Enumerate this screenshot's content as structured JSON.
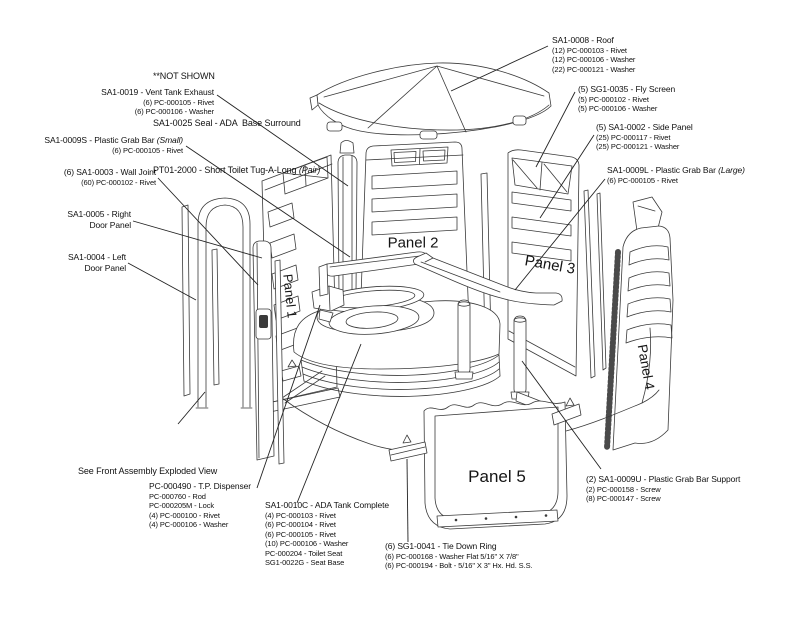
{
  "diagram": {
    "colors": {
      "background": "#ffffff",
      "ink": "#111111",
      "art_line": "#3a3a3a",
      "leader_line": "#222222"
    },
    "not_shown": {
      "line1": "**NOT SHOWN",
      "line2": "SA1-0025 Seal - ADA  Base Surround",
      "line3": "PT01-2000 - Short Toilet Tug-A-Long ",
      "line3_italic": "(Pair)"
    },
    "note": {
      "text": "See Front Assembly Exploded View",
      "leader": [
        178,
        424,
        205,
        392
      ]
    },
    "labels": [
      {
        "id": "roof",
        "title": "SA1-0008 - Roof",
        "subs": [
          "(12) PC-000103 - Rivet",
          "(12) PC-000106 - Washer",
          "(22) PC-000121 - Washer"
        ],
        "x": 552,
        "y": 35,
        "align": "left",
        "leader": [
          548,
          46,
          451,
          91
        ]
      },
      {
        "id": "fly-screen",
        "title": "(5) SG1-0035 - Fly Screen",
        "subs": [
          "(5) PC-000102 - Rivet",
          "(5) PC-000106 - Washer"
        ],
        "x": 578,
        "y": 84,
        "align": "left",
        "leader": [
          575,
          92,
          536,
          167
        ]
      },
      {
        "id": "side-panel",
        "title": "(5) SA1-0002 - Side Panel",
        "subs": [
          "(25) PC-000117 - Rivet",
          "(25) PC-000121 - Washer"
        ],
        "x": 596,
        "y": 122,
        "align": "left",
        "leader": [
          594,
          135,
          540,
          218
        ]
      },
      {
        "id": "grab-bar-large",
        "title": "SA1-0009L - Plastic Grab Bar ",
        "title_italic": "(Large)",
        "subs": [
          "(6) PC-000105 - Rivet"
        ],
        "x": 607,
        "y": 165,
        "align": "left",
        "leader": [
          605,
          179,
          515,
          290
        ]
      },
      {
        "id": "grab-bar-support",
        "title": "(2) SA1-0009U - Plastic Grab Bar Support",
        "subs": [
          "(2) PC-000158 - Screw",
          "(8) PC-000147 - Screw"
        ],
        "x": 586,
        "y": 474,
        "align": "left",
        "leader": [
          601,
          469,
          522,
          361
        ]
      },
      {
        "id": "vent-exhaust",
        "title": "SA1-0019 - Vent Tank Exhaust",
        "subs": [
          "(6) PC-000105 - Rivet",
          "(6) PC-000106 - Washer"
        ],
        "x": 214,
        "y": 87,
        "align": "right",
        "leader": [
          217,
          95,
          348,
          186
        ]
      },
      {
        "id": "grab-bar-small",
        "title": "SA1-0009S - Plastic Grab Bar ",
        "title_italic": "(Small)",
        "subs": [
          "(6) PC-000105 - Rivet"
        ],
        "x": 183,
        "y": 135,
        "align": "right",
        "leader": [
          186,
          146,
          350,
          257
        ]
      },
      {
        "id": "wall-joint",
        "title": "(6) SA1-0003 - Wall Joint",
        "subs": [
          "(60) PC-000102 - Rivet"
        ],
        "x": 156,
        "y": 167,
        "align": "right",
        "leader": [
          158,
          178,
          258,
          285
        ]
      },
      {
        "id": "right-door",
        "title": "SA1-0005 - Right",
        "title2": "Door Panel",
        "subs": [],
        "x": 131,
        "y": 209,
        "align": "right",
        "leader": [
          133,
          221,
          262,
          258
        ]
      },
      {
        "id": "left-door",
        "title": "SA1-0004 - Left",
        "title2": "Door Panel",
        "subs": [],
        "x": 126,
        "y": 252,
        "align": "right",
        "leader": [
          128,
          263,
          196,
          300
        ]
      },
      {
        "id": "tp-dispenser",
        "title": "PC-000490 - T.P. Dispenser",
        "subs": [
          "PC-000760 - Rod",
          "PC-000205M - Lock",
          "(4) PC-000100 - Rivet",
          "(4) PC-000106 - Washer"
        ],
        "x": 149,
        "y": 481,
        "align": "left",
        "leader": [
          257,
          488,
          320,
          305
        ]
      },
      {
        "id": "ada-tank",
        "title": "SA1-0010C - ADA Tank Complete",
        "subs": [
          "(4) PC-000103 - Rivet",
          "(6) PC-000104 - Rivet",
          "(6) PC-000105 - Rivet",
          "(10) PC-000106 - Washer",
          "PC-000204 - Toilet Seat",
          "SG1-0022G - Seat Base"
        ],
        "x": 265,
        "y": 500,
        "align": "left",
        "leader": [
          297,
          503,
          361,
          344
        ]
      },
      {
        "id": "tie-down-ring",
        "title": "(6) SG1-0041 - Tie Down Ring",
        "subs": [
          "(6) PC-000168 - Washer Flat 5/16\" X 7/8\"",
          "(6) PC-000194 - Bolt - 5/16\" X 3\" Hx. Hd. S.S."
        ],
        "x": 385,
        "y": 541,
        "align": "left",
        "leader": [
          408,
          542,
          407,
          459
        ]
      }
    ],
    "panel_tags": [
      {
        "label": "Panel 1",
        "x": 290,
        "y": 296,
        "rot": 84,
        "size": 13
      },
      {
        "label": "Panel 2",
        "x": 413,
        "y": 243,
        "rot": 0,
        "size": 15
      },
      {
        "label": "Panel 3",
        "x": 550,
        "y": 265,
        "rot": 10,
        "size": 15
      },
      {
        "label": "Panel 4",
        "x": 646,
        "y": 367,
        "rot": 80,
        "size": 13.5
      },
      {
        "label": "Panel 5",
        "x": 497,
        "y": 477,
        "rot": 0,
        "size": 17
      }
    ]
  }
}
